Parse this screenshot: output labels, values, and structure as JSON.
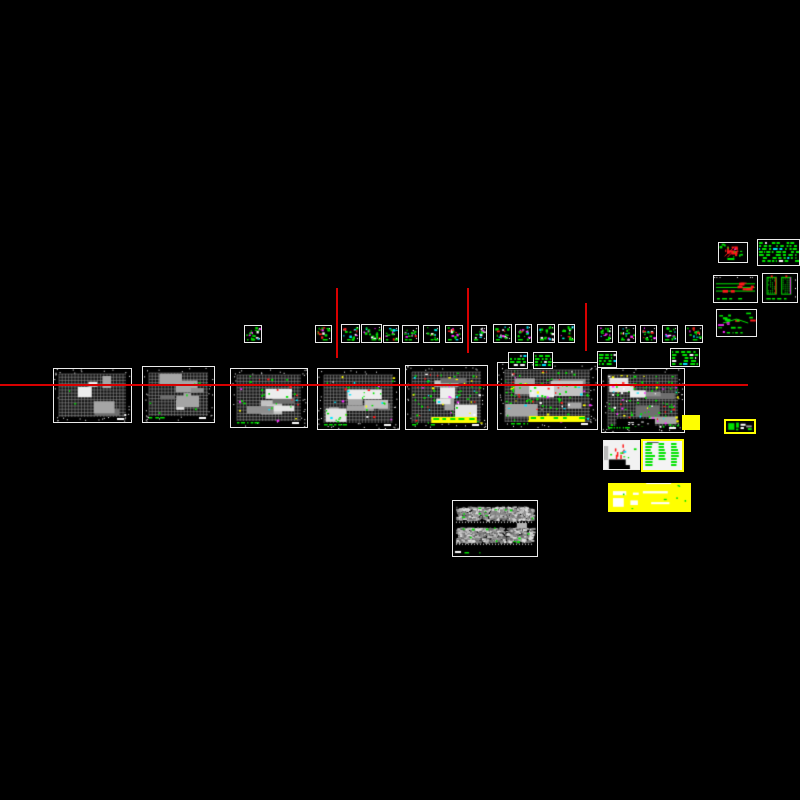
{
  "canvas": {
    "width": 800,
    "height": 800,
    "background": "#000000",
    "description": "CAD model space with structural drawing sheets"
  },
  "palette": {
    "background": "#000000",
    "line_red": "#d90000",
    "sheet_border": "#ebebeb",
    "ink_white": "#ffffff",
    "ink_gray": "#9c9c9c",
    "green": "#00e400",
    "red": "#ff1a1a",
    "magenta": "#ff2bff",
    "cyan": "#00e5ff",
    "yellow": "#ffff00"
  },
  "guide_lines": [
    {
      "name": "construction-line-horizontal",
      "x": 0,
      "y": 384,
      "w": 748,
      "h": 1.6
    },
    {
      "name": "construction-line-vertical-1",
      "x": 336,
      "y": 288,
      "w": 1.6,
      "h": 70
    },
    {
      "name": "construction-line-vertical-2",
      "x": 467,
      "y": 288,
      "w": 1.6,
      "h": 65
    },
    {
      "name": "construction-line-vertical-3",
      "x": 585,
      "y": 303,
      "w": 1.6,
      "h": 48
    }
  ],
  "sheets": [
    {
      "name": "sheet-floor-plan-01",
      "kind": "floorplan",
      "x": 53,
      "y": 368,
      "w": 79,
      "h": 55,
      "annot": 3,
      "greenNotes": false
    },
    {
      "name": "sheet-floor-plan-02",
      "kind": "floorplan",
      "x": 142,
      "y": 366,
      "w": 73,
      "h": 57,
      "annot": 8,
      "greenNotes": true
    },
    {
      "name": "sheet-floor-plan-03",
      "kind": "floorplan",
      "x": 230,
      "y": 368,
      "w": 78,
      "h": 60,
      "annot": 30,
      "greenNotes": true
    },
    {
      "name": "sheet-floor-plan-04",
      "kind": "floorplan",
      "x": 317,
      "y": 368,
      "w": 83,
      "h": 62,
      "annot": 38,
      "greenNotes": true
    },
    {
      "name": "sheet-floor-plan-05",
      "kind": "floorplan",
      "x": 405,
      "y": 365,
      "w": 83,
      "h": 65,
      "annot": 85,
      "greenNotes": true,
      "yellowBand": true
    },
    {
      "name": "sheet-floor-plan-06",
      "kind": "floorplan",
      "x": 497,
      "y": 362,
      "w": 101,
      "h": 68,
      "annot": 100,
      "greenNotes": true,
      "yellowBand": true
    },
    {
      "name": "sheet-floor-plan-07",
      "kind": "floorplan",
      "x": 601,
      "y": 368,
      "w": 84,
      "h": 65,
      "annot": 115,
      "greenNotes": true,
      "blackTitle": true
    },
    {
      "name": "sheet-detail-01",
      "kind": "detail-card",
      "x": 244,
      "y": 325,
      "w": 18,
      "h": 18
    },
    {
      "name": "sheet-detail-02",
      "kind": "detail-card",
      "x": 315,
      "y": 325,
      "w": 17,
      "h": 18
    },
    {
      "name": "sheet-detail-03",
      "kind": "detail-card",
      "x": 341,
      "y": 324,
      "w": 19,
      "h": 19
    },
    {
      "name": "sheet-detail-04",
      "kind": "detail-card",
      "x": 361,
      "y": 324,
      "w": 21,
      "h": 19
    },
    {
      "name": "sheet-detail-05",
      "kind": "detail-card",
      "x": 383,
      "y": 325,
      "w": 16,
      "h": 18
    },
    {
      "name": "sheet-detail-06",
      "kind": "detail-card",
      "x": 402,
      "y": 325,
      "w": 17,
      "h": 18
    },
    {
      "name": "sheet-detail-07",
      "kind": "detail-card",
      "x": 423,
      "y": 325,
      "w": 17,
      "h": 18
    },
    {
      "name": "sheet-detail-08",
      "kind": "detail-card",
      "x": 445,
      "y": 325,
      "w": 18,
      "h": 18
    },
    {
      "name": "sheet-detail-09",
      "kind": "detail-card",
      "x": 471,
      "y": 325,
      "w": 16,
      "h": 18
    },
    {
      "name": "sheet-detail-10",
      "kind": "detail-card",
      "x": 493,
      "y": 324,
      "w": 19,
      "h": 19
    },
    {
      "name": "sheet-detail-11",
      "kind": "detail-card",
      "x": 515,
      "y": 324,
      "w": 17,
      "h": 19
    },
    {
      "name": "sheet-detail-12",
      "kind": "detail-card",
      "x": 537,
      "y": 324,
      "w": 18,
      "h": 19
    },
    {
      "name": "sheet-detail-13",
      "kind": "detail-card",
      "x": 558,
      "y": 324,
      "w": 17,
      "h": 19
    },
    {
      "name": "sheet-detail-14",
      "kind": "detail-card",
      "x": 597,
      "y": 325,
      "w": 16,
      "h": 18
    },
    {
      "name": "sheet-detail-15",
      "kind": "detail-card",
      "x": 618,
      "y": 325,
      "w": 18,
      "h": 18
    },
    {
      "name": "sheet-detail-16",
      "kind": "detail-card",
      "x": 640,
      "y": 325,
      "w": 17,
      "h": 18
    },
    {
      "name": "sheet-detail-17",
      "kind": "detail-card",
      "x": 662,
      "y": 325,
      "w": 16,
      "h": 18
    },
    {
      "name": "sheet-detail-18",
      "kind": "detail-card",
      "x": 685,
      "y": 325,
      "w": 18,
      "h": 18
    },
    {
      "name": "sheet-note-01",
      "kind": "note-green",
      "x": 508,
      "y": 352,
      "w": 20,
      "h": 17
    },
    {
      "name": "sheet-note-02",
      "kind": "note-green",
      "x": 533,
      "y": 352,
      "w": 20,
      "h": 17
    },
    {
      "name": "sheet-note-03",
      "kind": "note-green",
      "x": 597,
      "y": 351,
      "w": 20,
      "h": 17
    },
    {
      "name": "sheet-note-04",
      "kind": "note-green",
      "x": 670,
      "y": 348,
      "w": 30,
      "h": 19
    },
    {
      "name": "sheet-detail-red-a",
      "kind": "detail-red",
      "style": "a",
      "x": 718,
      "y": 242,
      "w": 30,
      "h": 21
    },
    {
      "name": "sheet-note-top-right",
      "kind": "note-green",
      "x": 757,
      "y": 239,
      "w": 43,
      "h": 27
    },
    {
      "name": "sheet-detail-red-c",
      "kind": "detail-red",
      "style": "c",
      "x": 713,
      "y": 275,
      "w": 45,
      "h": 28
    },
    {
      "name": "sheet-hatch-detail",
      "kind": "hatch-pair",
      "x": 762,
      "y": 273,
      "w": 36,
      "h": 30
    },
    {
      "name": "sheet-detail-red-e",
      "kind": "detail-red",
      "style": "e",
      "x": 716,
      "y": 309,
      "w": 41,
      "h": 28
    },
    {
      "name": "sheet-elevation",
      "kind": "elevation",
      "x": 452,
      "y": 500,
      "w": 86,
      "h": 57
    },
    {
      "name": "sheet-white-note",
      "kind": "white-note",
      "x": 603,
      "y": 440,
      "w": 37,
      "h": 30
    },
    {
      "name": "sheet-schedule-highlight",
      "kind": "schedule-yellow",
      "x": 641,
      "y": 439,
      "w": 43,
      "h": 33
    },
    {
      "name": "highlight-yellow-rect",
      "kind": "yellow-rect",
      "x": 682,
      "y": 415,
      "w": 18,
      "h": 15
    },
    {
      "name": "sheet-callout-highlight",
      "kind": "callout-yellow",
      "x": 724,
      "y": 419,
      "w": 32,
      "h": 15
    },
    {
      "name": "highlight-yellow-block",
      "kind": "yellow-block",
      "x": 608,
      "y": 483,
      "w": 83,
      "h": 29
    }
  ]
}
